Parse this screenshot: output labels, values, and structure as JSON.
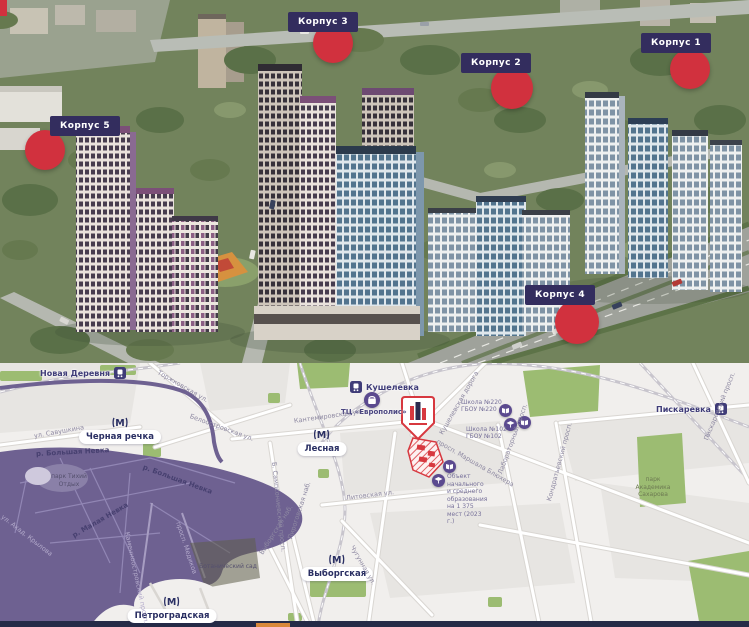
{
  "site_plan": {
    "markers": [
      {
        "label": "Корпус 1"
      },
      {
        "label": "Корпус 2"
      },
      {
        "label": "Корпус 3"
      },
      {
        "label": "Корпус 4"
      },
      {
        "label": "Корпус 5"
      }
    ]
  },
  "map": {
    "metro": [
      {
        "name": "Черная речка"
      },
      {
        "name": "Лесная"
      },
      {
        "name": "Выборгская"
      },
      {
        "name": "Петроградская"
      }
    ],
    "rail": [
      {
        "name": "Новая Деревня"
      },
      {
        "name": "Кушелевка"
      },
      {
        "name": "Пискаревка"
      }
    ],
    "streets": [
      "Торжковская ул.",
      "Белоостровская ул.",
      "ул. Савушкина",
      "Кантемировская ул.",
      "Кушелевская дорога",
      "просп. Маршала Блюхера",
      "Лабораторный просп.",
      "Кондратьевский просп.",
      "Пискаревский просп.",
      "Литовская ул.",
      "Чугунная ул.",
      "Б. Сампсониевский просп.",
      "Пироговская наб.",
      "Выборгская наб.",
      "Каменноостровский просп.",
      "просп. Медиков",
      "ул. Акад. Крылова"
    ],
    "waterways": [
      "р. Большая Невка",
      "р. Большая Невка",
      "р. Малая Невка"
    ],
    "parks": [
      {
        "name": "парк Тихий Отдых"
      },
      {
        "name": "Ботанический сад"
      },
      {
        "name": "парк Академика Сахарова"
      }
    ],
    "pois": [
      {
        "name": "ТЦ «Европолис»"
      },
      {
        "name": "Школа №220",
        "org": "ГБОУ №220"
      },
      {
        "name": "Школа №102",
        "org": "ГБОУ №102"
      },
      {
        "name": "Объект начального и среднего образования на 1 375 мест (2023 г.)"
      }
    ]
  },
  "icons": {
    "metro_glyph": "М"
  },
  "colors": {
    "accent_red": "#d1313e",
    "label_navy": "#332d5e",
    "map_water": "#6e6191",
    "map_green": "#9cbc72",
    "metro_navy": "#2a2f63",
    "bottom_bar": "#252b47",
    "bottom_accent": "#d9883a"
  }
}
